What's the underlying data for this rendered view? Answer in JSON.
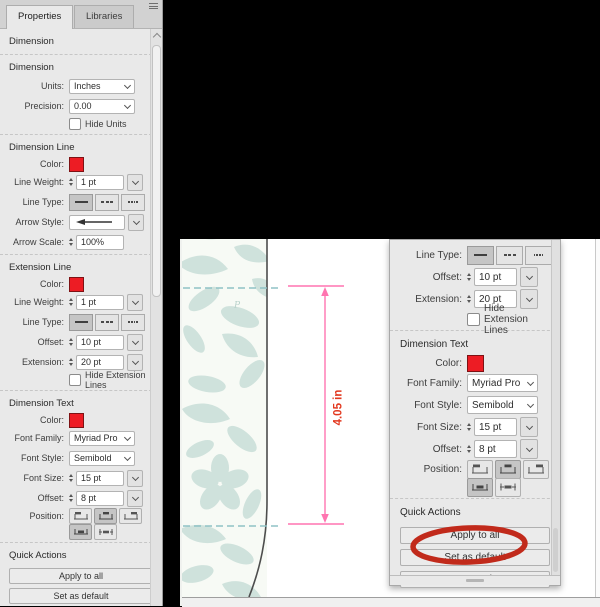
{
  "tabs": {
    "properties": "Properties",
    "libraries": "Libraries"
  },
  "panel_title": "Dimension",
  "headers": {
    "dimension": "Dimension",
    "dimension_line": "Dimension Line",
    "extension_line": "Extension Line",
    "dimension_text": "Dimension Text",
    "quick_actions": "Quick Actions"
  },
  "labels": {
    "units": "Units:",
    "precision": "Precision:",
    "hide_units": "Hide Units",
    "color": "Color:",
    "line_weight": "Line Weight:",
    "line_type": "Line Type:",
    "arrow_style": "Arrow Style:",
    "arrow_scale": "Arrow Scale:",
    "offset": "Offset:",
    "extension": "Extension:",
    "hide_extension_lines": "Hide Extension Lines",
    "font_family": "Font Family:",
    "font_style": "Font Style:",
    "font_size": "Font Size:",
    "position": "Position:"
  },
  "values": {
    "units": "Inches",
    "precision": "0.00",
    "line_weight": "1 pt",
    "arrow_scale": "100%",
    "offset": "10 pt",
    "extension": "20 pt",
    "font_family": "Myriad Pro",
    "font_style": "Semibold",
    "font_size": "15 pt",
    "text_offset": "8 pt"
  },
  "buttons": {
    "apply_to_all": "Apply to all",
    "set_as_default": "Set as default",
    "expand": "Expand"
  },
  "canvas": {
    "dimension_label": "4.05 in"
  },
  "colors": {
    "panel_bg": "#e9e9e9",
    "swatch_red": "#ed1c24",
    "dimension_pink": "#ff74b0",
    "dimension_text_red": "#e2381f",
    "annotation_red": "#c12a1b",
    "teal_dash": "#8fc2c5",
    "pattern_teal": "#cfe2dc",
    "pattern_bg": "#f7faf5"
  }
}
